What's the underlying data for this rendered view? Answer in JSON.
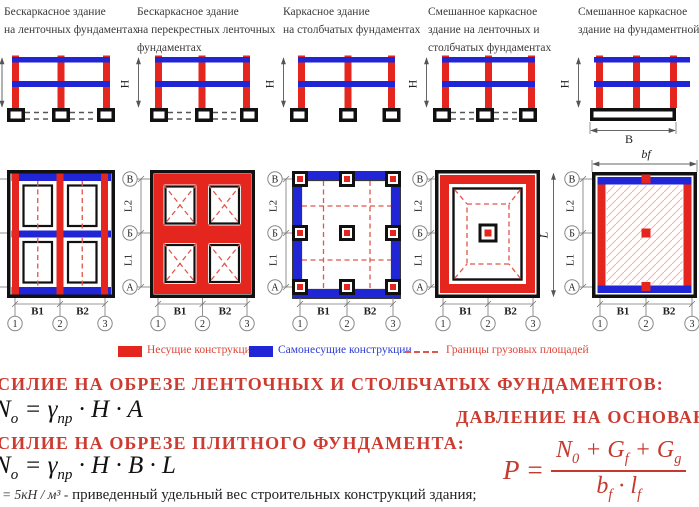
{
  "palette": {
    "bearing_red": "#e5261e",
    "selfbearing_blue": "#2026d6",
    "boundary_dash_red": "#e0564a",
    "heading_red": "#cd3a30",
    "formula_red": "#c5392e"
  },
  "headers": [
    {
      "lines": [
        "Бескаркасное здание",
        "на ленточных фундаментах"
      ]
    },
    {
      "lines": [
        "Бескаркасное здание",
        "на перекрестных ленточных",
        "фундаментах"
      ]
    },
    {
      "lines": [
        "Каркасное здание",
        "на столбчатых фундаментах"
      ]
    },
    {
      "lines": [
        "Смешанное каркасное",
        "здание на ленточных и",
        "столбчатых фундаментах"
      ]
    },
    {
      "lines": [
        "Смешанное каркасное",
        "здание на фундаментной п"
      ]
    }
  ],
  "axis": {
    "h": "H",
    "b": "B",
    "bf": "bf",
    "l": "L",
    "l1": "L1",
    "l2": "L2",
    "b1": "B1",
    "b2": "B2",
    "row_top": "В",
    "row_mid": "Б",
    "row_bot": "А",
    "col1": "1",
    "col2": "2",
    "col3": "3"
  },
  "legend": {
    "bearing": "Несущие конструкции",
    "self_bearing": "Самонесущие конструкции",
    "boundaries": "Границы грузовых площадей"
  },
  "formulas": {
    "title_strip": "СИЛИЕ НА ОБРЕЗЕ ЛЕНТОЧНЫХ И СТОЛБЧАТЫХ ФУНДАМЕНТОВ:",
    "title_pressure": "ДАВЛЕНИЕ НА ОСНОВАНИ",
    "title_slab": "СИЛИЕ НА ОБРЕЗЕ ПЛИТНОГО ФУНДАМЕНТА:",
    "f1": {
      "lhs": "N",
      "lhs_sub": "o",
      "eq": " = ",
      "gamma": "γ",
      "gamma_sub": "пр",
      "tail": " · H · A"
    },
    "f2": {
      "lhs": "N",
      "lhs_sub": "o",
      "eq": " = ",
      "gamma": "γ",
      "gamma_sub": "пр",
      "tail": " · H · B · L"
    },
    "p": {
      "lhs": "P =",
      "num_1": "N",
      "num_1_sub": "0",
      "num_2": " + G",
      "num_2_sub": "f",
      "num_3": " + G",
      "num_3_sub": "g",
      "den_1": "b",
      "den_1_sub": "f",
      "den_2": " · ",
      "den_3": "l",
      "den_3_sub": "f"
    },
    "note": {
      "math": "= 5кН / м³ -",
      "text": "приведенный удельный вес строительных конструкций здания;"
    }
  }
}
